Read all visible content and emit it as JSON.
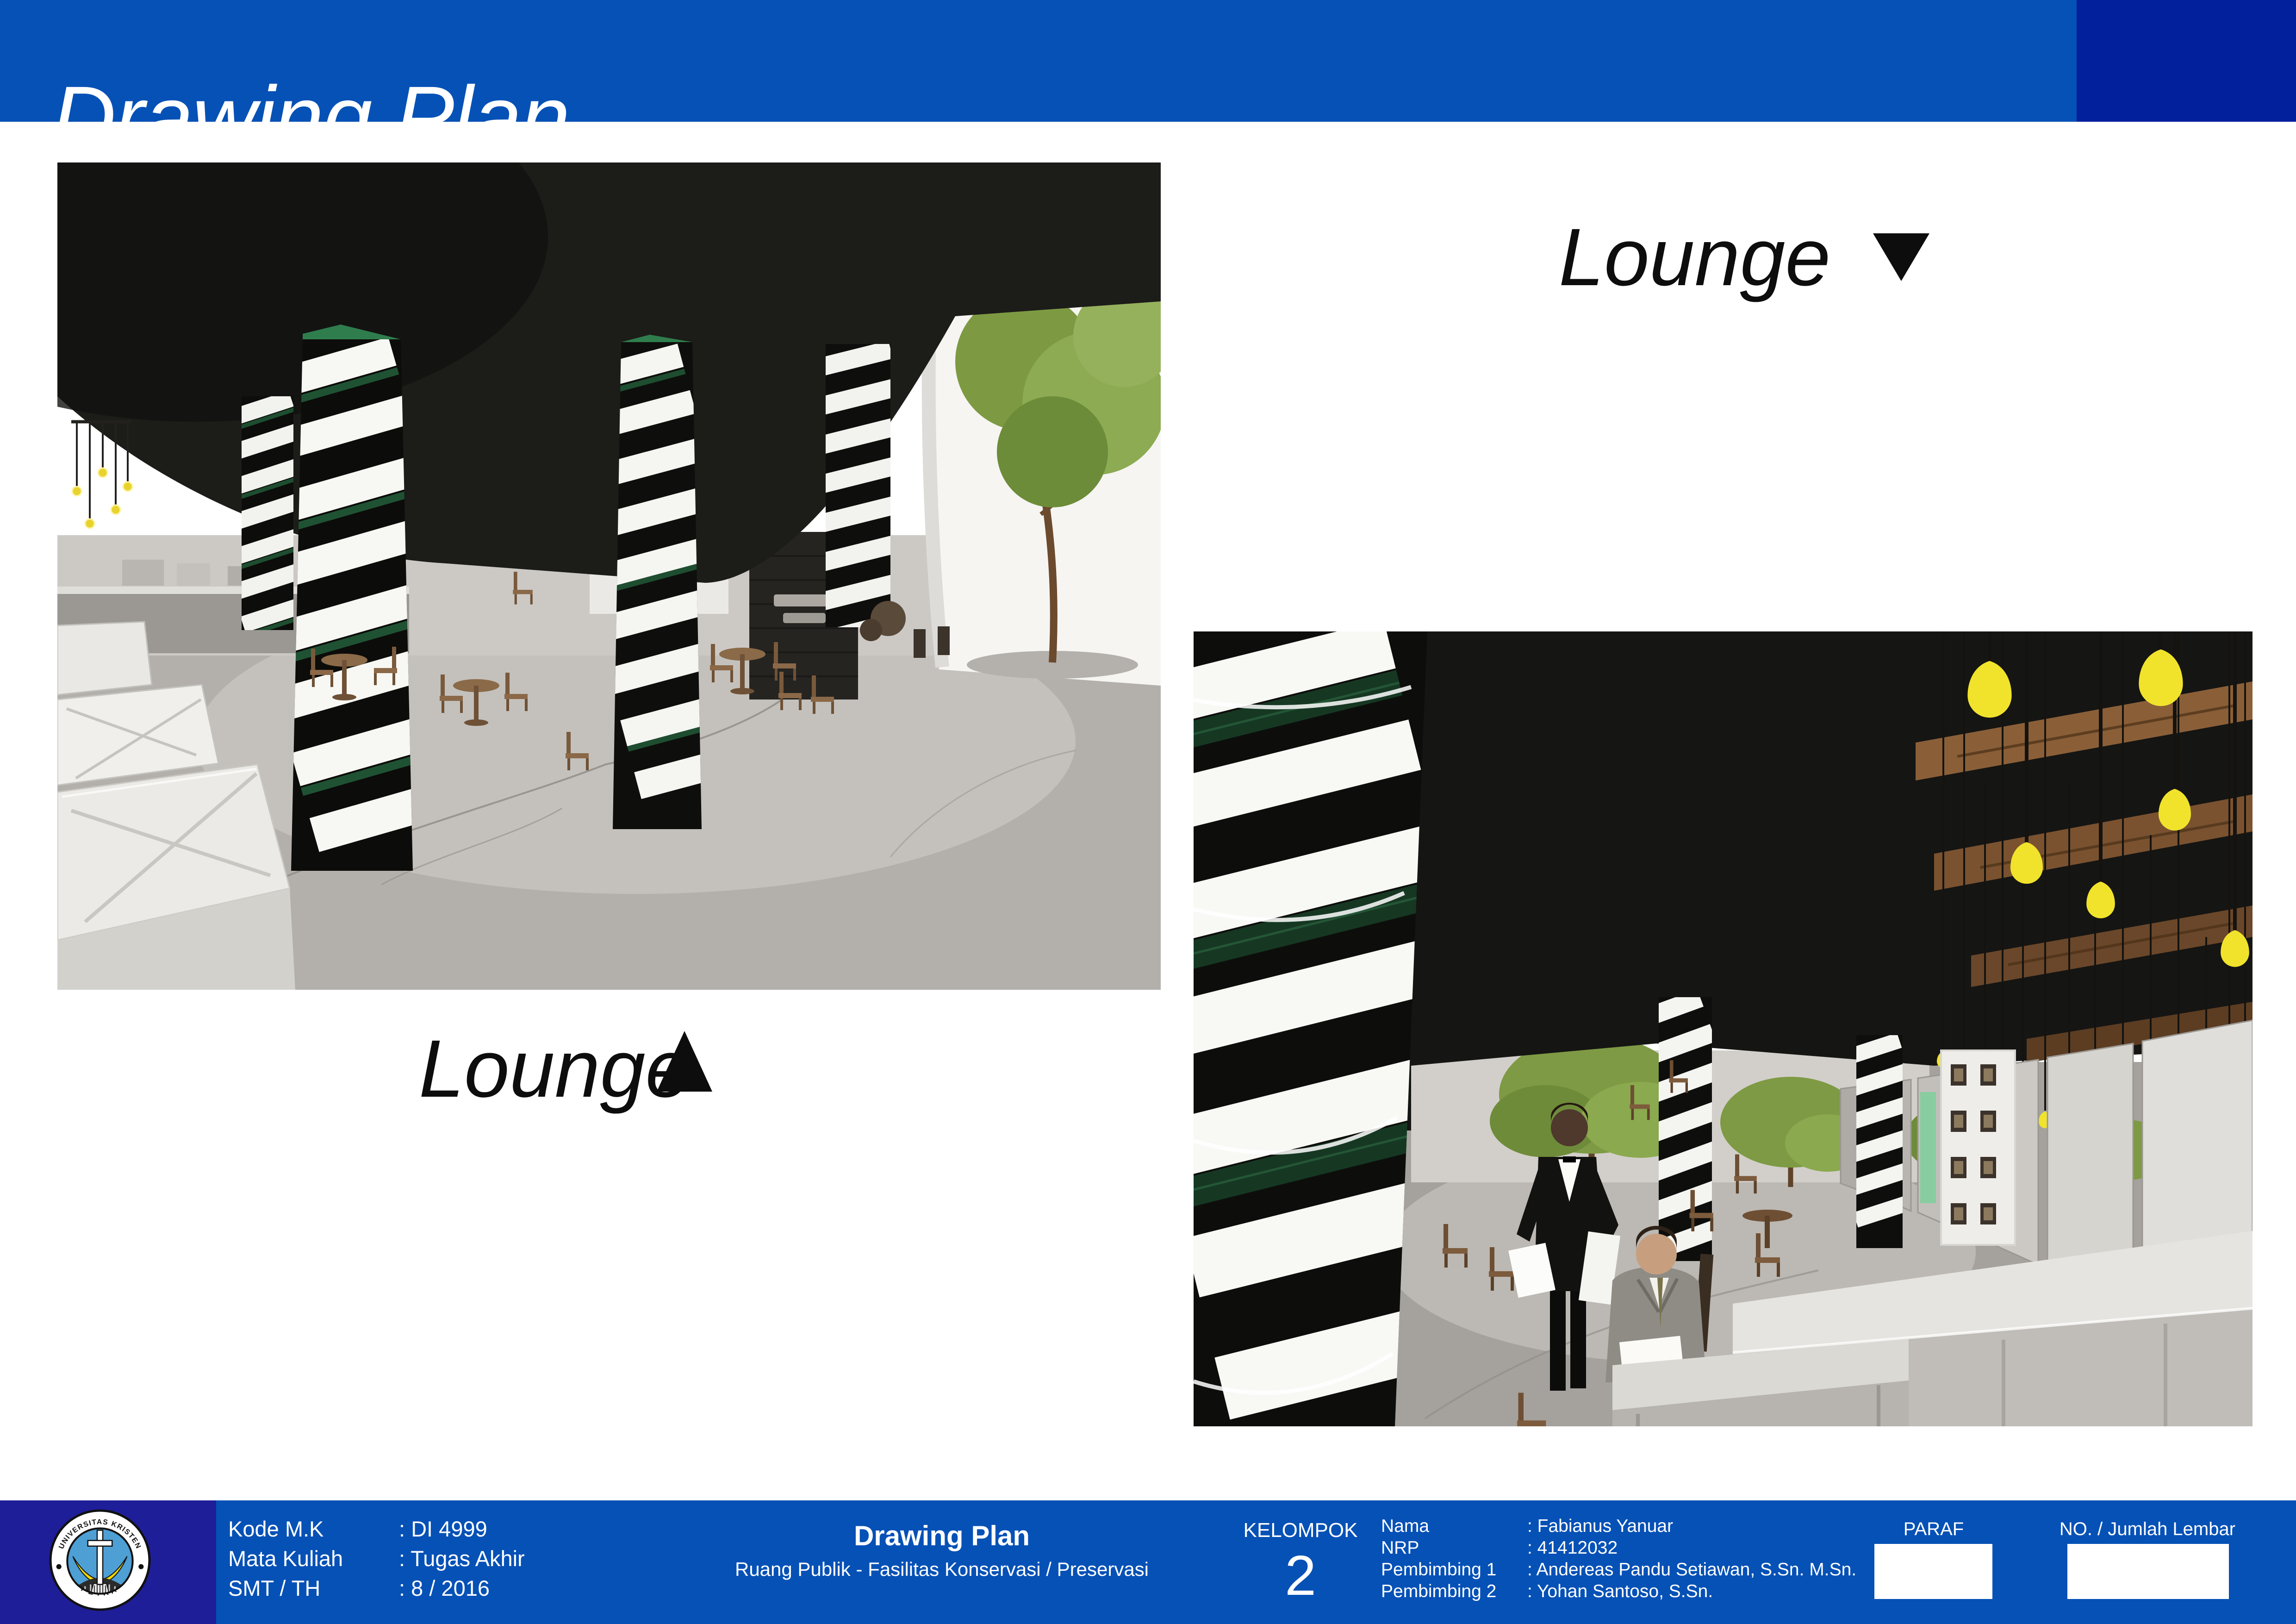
{
  "header": {
    "title": "Drawing Plan"
  },
  "captions": {
    "left": {
      "text": "Lounge",
      "marker_direction": "up"
    },
    "right": {
      "text": "Lounge",
      "marker_direction": "down"
    }
  },
  "renders": {
    "left_alt": "interior lounge render with spiral striped light columns, wooden cafe chairs, white display tables, concrete floor, dark ceiling",
    "right_alt": "lounge render with giant spiral column, waiter serving seated guest, trees, white wall panels and hanging yellow bulbs"
  },
  "footer": {
    "course": {
      "rows": [
        {
          "label": "Kode M.K",
          "value": ": DI 4999"
        },
        {
          "label": "Mata Kuliah",
          "value": ": Tugas Akhir"
        },
        {
          "label": "SMT / TH",
          "value": ": 8 / 2016"
        }
      ]
    },
    "sheet_title": "Drawing Plan",
    "sheet_subtitle": "Ruang Publik - Fasilitas Konservasi / Preservasi",
    "group_label": "KELOMPOK",
    "group_number": "2",
    "people": {
      "rows": [
        {
          "label": "Nama",
          "value": ": Fabianus Yanuar"
        },
        {
          "label": "NRP",
          "value": ": 41412032"
        },
        {
          "label": "Pembimbing 1",
          "value": ": Andereas Pandu Setiawan, S.Sn. M.Sn."
        },
        {
          "label": "Pembimbing 2",
          "value": ": Yohan Santoso, S.Sn."
        }
      ]
    },
    "paraf_label": "PARAF",
    "sheet_no_label": "NO. / Jumlah Lembar",
    "logo": {
      "arc_text": "UNIVERSITAS KRISTEN",
      "bottom_text": "PETRA"
    }
  },
  "colors": {
    "bar_blue": "#0651b6",
    "bar_dark_accent": "#02209b",
    "logo_panel_navy": "#1e1e99",
    "caption_text": "#0d0d0d",
    "bulb_yellow": "#f1e32b"
  }
}
